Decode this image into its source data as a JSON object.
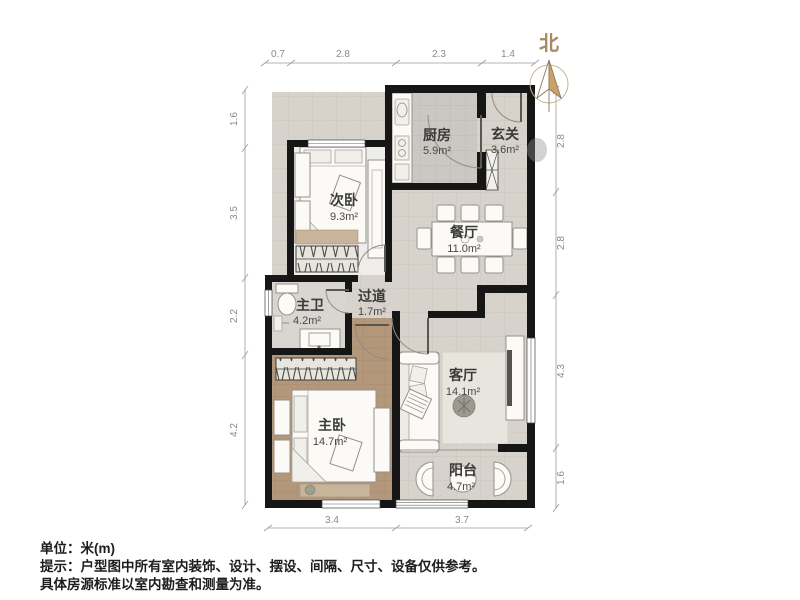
{
  "north": {
    "label": "北"
  },
  "rooms": {
    "kitchen": {
      "name": "厨房",
      "area": "5.9m²"
    },
    "entry": {
      "name": "玄关",
      "area": "3.6m²"
    },
    "bedroom2": {
      "name": "次卧",
      "area": "9.3m²"
    },
    "dining": {
      "name": "餐厅",
      "area": "11.0m²"
    },
    "hallway": {
      "name": "过道",
      "area": "1.7m²"
    },
    "bathroom": {
      "name": "主卫",
      "area": "4.2m²"
    },
    "living": {
      "name": "客厅",
      "area": "14.1m²"
    },
    "bedroom1": {
      "name": "主卧",
      "area": "14.7m²"
    },
    "balcony": {
      "name": "阳台",
      "area": "4.7m²"
    }
  },
  "dimensions": {
    "top": [
      "0.7",
      "2.8",
      "2.3",
      "1.4"
    ],
    "left": [
      "1.6",
      "3.5",
      "2.2",
      "4.2"
    ],
    "right": [
      "2.8",
      "2.8",
      "4.3",
      "1.6"
    ],
    "bottom": [
      "3.4",
      "3.7"
    ]
  },
  "notes": {
    "unit": "单位：米(m)",
    "tip_line1": "提示：户型图中所有室内装饰、设计、摆设、间隔、尺寸、设备仅供参考。",
    "tip_line2": "具体房源标准以室内勘查和测量为准。"
  },
  "colors": {
    "wall": "#161616",
    "tile_floor": "#d8d4ce",
    "wood_floor": "#b2977a",
    "bedroom_floor": "#efede9",
    "north_accent": "#c9a169"
  }
}
